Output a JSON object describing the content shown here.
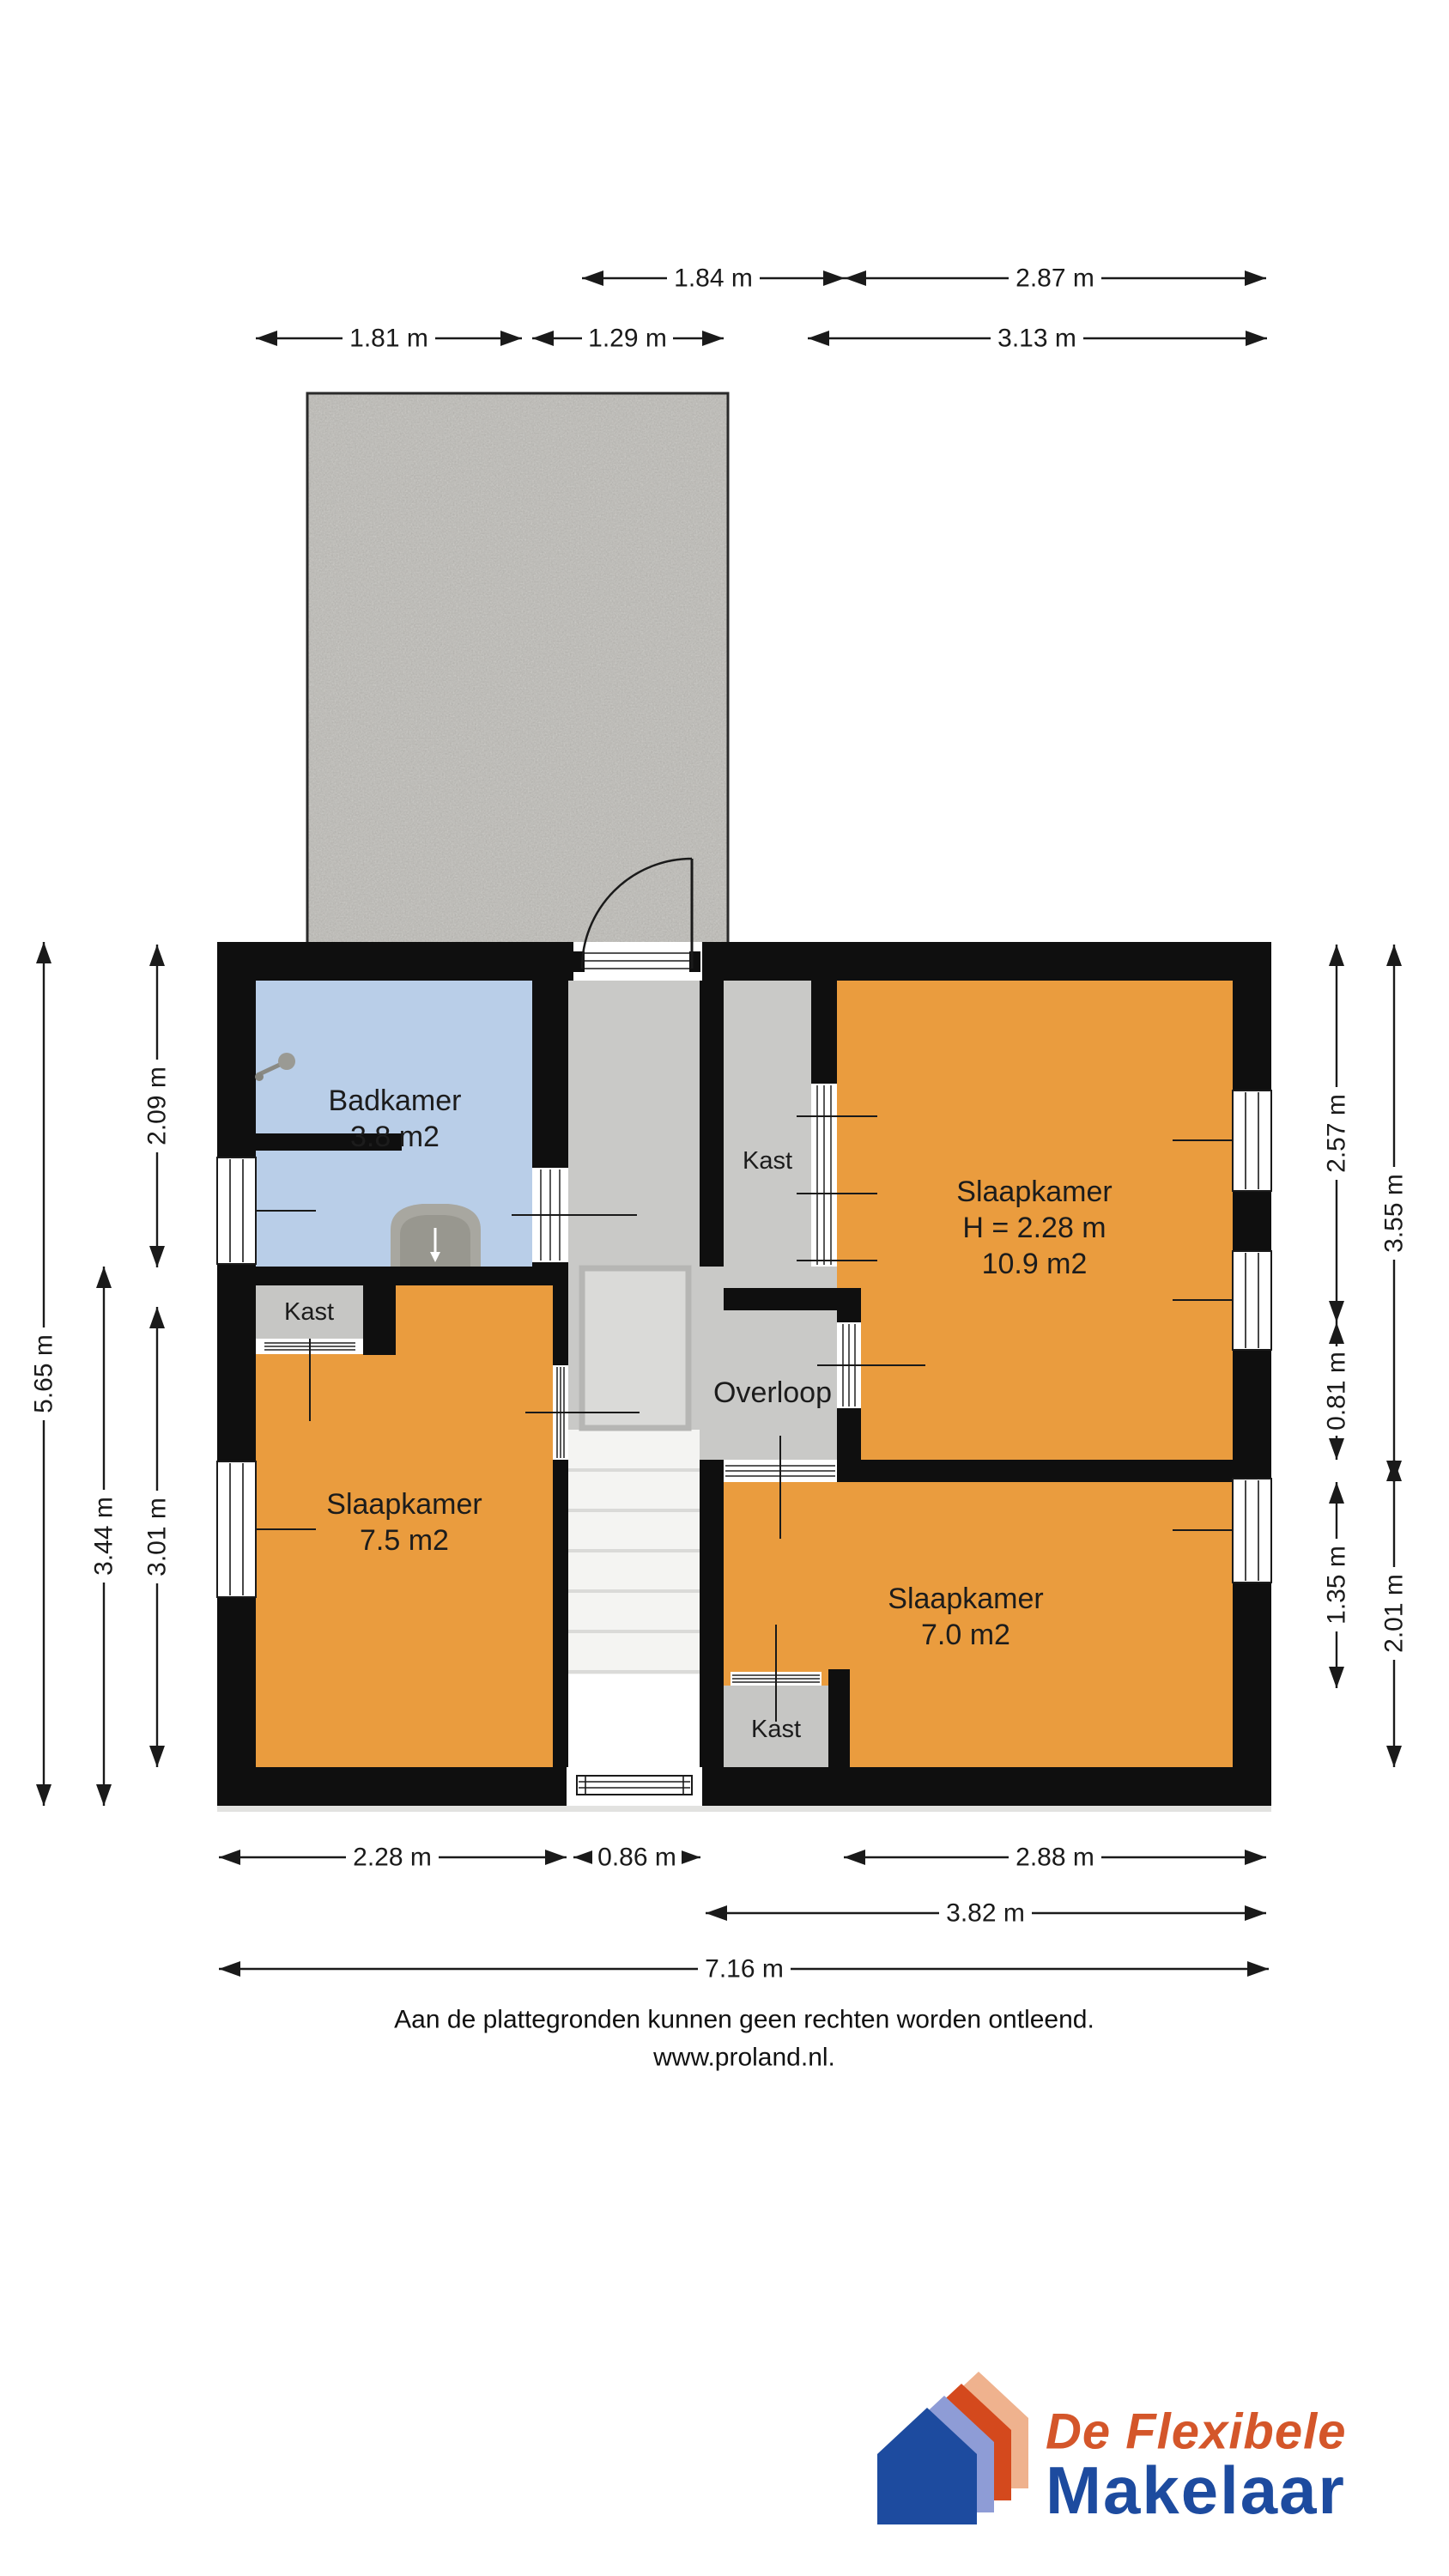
{
  "rooms": {
    "badkamer": {
      "name": "Badkamer",
      "area": "3.8 m2"
    },
    "slaapkamer_groot": {
      "name": "Slaapkamer",
      "ceiling_height": "H = 2.28 m",
      "area": "10.9 m2"
    },
    "slaapkamer_links": {
      "name": "Slaapkamer",
      "area": "7.5 m2"
    },
    "slaapkamer_rechts": {
      "name": "Slaapkamer",
      "area": "7.0 m2"
    },
    "overloop": {
      "name": "Overloop"
    },
    "kast_top": {
      "name": "Kast"
    },
    "kast_links": {
      "name": "Kast"
    },
    "kast_onder": {
      "name": "Kast"
    }
  },
  "dim_top": {
    "a": "1.84 m",
    "b": "2.87 m",
    "c": "1.81 m",
    "d": "1.29 m",
    "e": "3.13 m"
  },
  "dim_left": {
    "total": "5.65 m",
    "lower": "3.44 m",
    "inner_top": "2.09 m",
    "inner_bottom": "3.01 m"
  },
  "dim_right": {
    "inner_top": "2.57 m",
    "outer_top": "3.55 m",
    "inner_mid": "0.81 m",
    "inner_bottom": "1.35 m",
    "outer_bottom": "2.01 m"
  },
  "dim_bottom": {
    "a": "2.28 m",
    "b": "0.86 m",
    "c": "2.88 m",
    "d": "3.82 m",
    "e": "7.16 m"
  },
  "footer": {
    "disclaimer": "Aan de plattegronden kunnen geen rechten worden ontleend.",
    "website": "www.proland.nl."
  },
  "logo": {
    "brand_line1": "De Flexibele",
    "brand_line2": "Makelaar"
  },
  "colors": {
    "room_orange": "#EA9C3E",
    "room_blue": "#B9CEE8",
    "hall_grey": "#C9C9C7",
    "kast_grey": "#C6C6C4",
    "terrace_grey": "#C9C8C4",
    "wall_black": "#0F0F0F",
    "logo_blue": "#1D4B9F",
    "logo_periwinkle": "#8E9CD6",
    "logo_vermilion": "#D4491D",
    "logo_peach": "#EFB28E",
    "logo_text_orange": "#D4562A"
  }
}
